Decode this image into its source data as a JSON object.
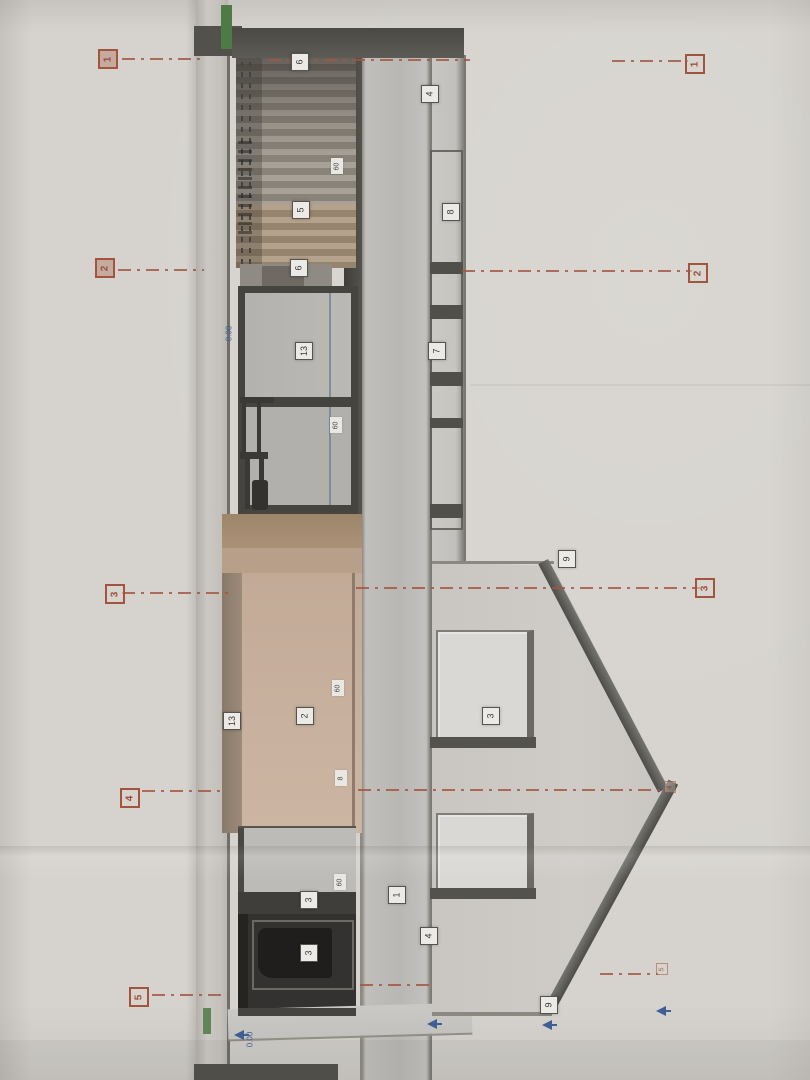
{
  "document": {
    "description": "Photograph of an architectural section/elevation drawing on light paper, rotated 90 degrees (roof gable points right, all text reads bottom-to-top)",
    "visible_text_rotation": "-90deg"
  },
  "colors": {
    "paper": "#d6d3ce",
    "axis_line_red": "#a3543f",
    "label_box_bg": "#eceae6",
    "label_text": "#3a3936",
    "level_blue": "#3e5f95",
    "brown_wall": "#c3ab98",
    "dark_frame": "#45443f",
    "green_insulation": "#4d7a45"
  },
  "axis_markers": {
    "left": [
      {
        "label": "1",
        "x": 98,
        "y": 49,
        "filled": true
      },
      {
        "label": "2",
        "x": 95,
        "y": 258,
        "filled": true
      },
      {
        "label": "3",
        "x": 105,
        "y": 584
      },
      {
        "label": "4",
        "x": 120,
        "y": 788
      },
      {
        "label": "5",
        "x": 129,
        "y": 987
      }
    ],
    "right": [
      {
        "label": "1",
        "x": 685,
        "y": 54
      },
      {
        "label": "2",
        "x": 688,
        "y": 263
      },
      {
        "label": "3",
        "x": 695,
        "y": 578
      },
      {
        "label": "4",
        "x": 664,
        "y": 781,
        "faint": true
      },
      {
        "label": "5",
        "x": 656,
        "y": 963,
        "faint": true
      }
    ]
  },
  "axis_lines": [
    {
      "id": "1",
      "segments": [
        {
          "x": 122,
          "y": 58,
          "w": 84
        },
        {
          "x": 268,
          "y": 59,
          "w": 202
        },
        {
          "x": 612,
          "y": 60,
          "w": 76
        }
      ]
    },
    {
      "id": "2",
      "segments": [
        {
          "x": 118,
          "y": 269,
          "w": 86
        },
        {
          "x": 462,
          "y": 270,
          "w": 230
        }
      ]
    },
    {
      "id": "3",
      "segments": [
        {
          "x": 122,
          "y": 592,
          "w": 108
        },
        {
          "x": 356,
          "y": 587,
          "w": 344
        }
      ]
    },
    {
      "id": "4",
      "segments": [
        {
          "x": 142,
          "y": 790,
          "w": 84
        },
        {
          "x": 358,
          "y": 789,
          "w": 310
        }
      ]
    },
    {
      "id": "5",
      "segments": [
        {
          "x": 152,
          "y": 994,
          "w": 76
        },
        {
          "x": 360,
          "y": 984,
          "w": 70
        },
        {
          "x": 600,
          "y": 973,
          "w": 58
        }
      ]
    }
  ],
  "component_labels": [
    {
      "text": "6",
      "x": 291,
      "y": 53
    },
    {
      "text": "4",
      "x": 421,
      "y": 85
    },
    {
      "text": "5",
      "x": 292,
      "y": 201
    },
    {
      "text": "8",
      "x": 442,
      "y": 203
    },
    {
      "text": "6",
      "x": 290,
      "y": 259
    },
    {
      "text": "13",
      "x": 295,
      "y": 342
    },
    {
      "text": "7",
      "x": 428,
      "y": 342
    },
    {
      "text": "9",
      "x": 558,
      "y": 550
    },
    {
      "text": "3",
      "x": 482,
      "y": 707
    },
    {
      "text": "2",
      "x": 296,
      "y": 707
    },
    {
      "text": "13",
      "x": 223,
      "y": 712
    },
    {
      "text": "1",
      "x": 388,
      "y": 886
    },
    {
      "text": "3",
      "x": 300,
      "y": 891
    },
    {
      "text": "4",
      "x": 420,
      "y": 927
    },
    {
      "text": "3",
      "x": 300,
      "y": 944
    },
    {
      "text": "9",
      "x": 540,
      "y": 996
    }
  ],
  "dimension_tags": [
    {
      "text": "60",
      "x": 331,
      "y": 158
    },
    {
      "text": "60",
      "x": 330,
      "y": 417
    },
    {
      "text": "60",
      "x": 332,
      "y": 680
    },
    {
      "text": "8",
      "x": 335,
      "y": 770
    },
    {
      "text": "60",
      "x": 334,
      "y": 874
    }
  ],
  "level_marks": [
    {
      "text": "0.00",
      "x": 224,
      "y": 316,
      "arrow": false
    },
    {
      "text": "0.00",
      "x": 245,
      "y": 1022,
      "arrow": true
    }
  ],
  "level_arrows": [
    {
      "x": 427,
      "y": 1019
    },
    {
      "x": 542,
      "y": 1020
    },
    {
      "x": 656,
      "y": 1006
    }
  ]
}
